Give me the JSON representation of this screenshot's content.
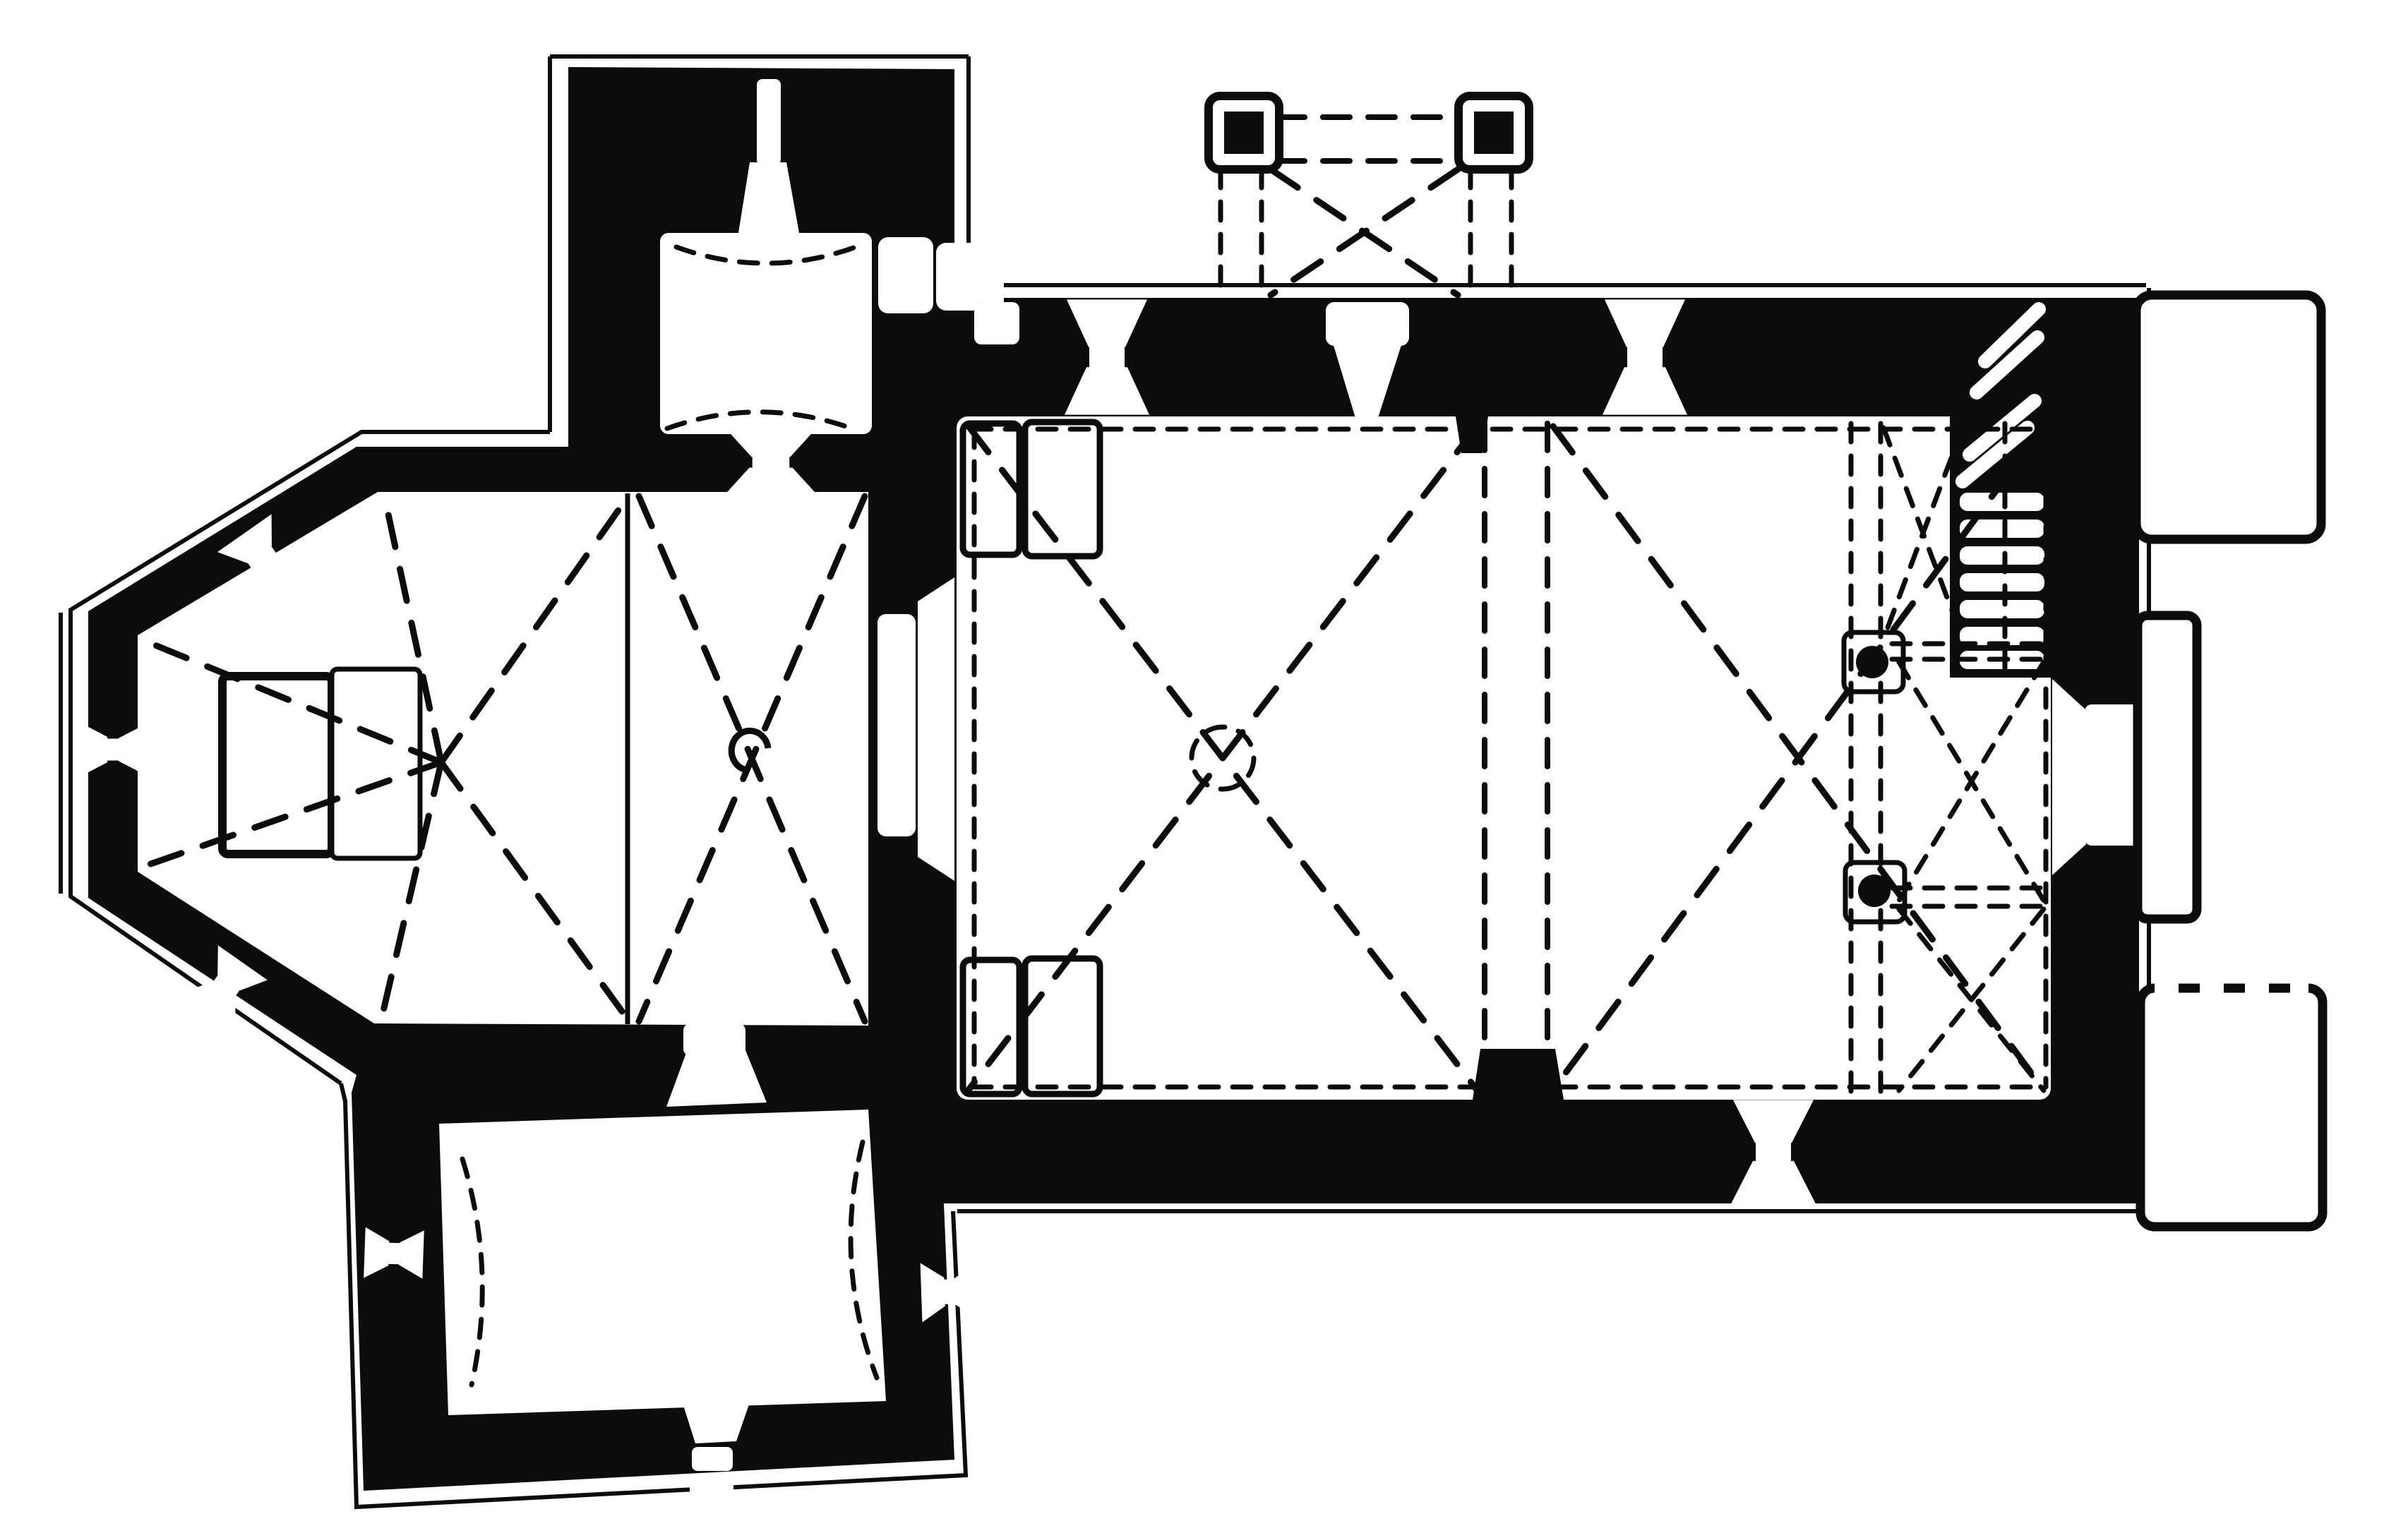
{
  "title": "Church floor plan (measured survey drawing, black ink on white)",
  "colors": {
    "ink": "#0c0c0c",
    "paper": "#ffffff"
  },
  "drawing": {
    "type": "architectural-floor-plan",
    "spaces": [
      {
        "id": "apse",
        "label": "Polygonal apse sanctuary with altar and radiating vault ribs"
      },
      {
        "id": "choir",
        "label": "Choir bay with cross rib vault and boss"
      },
      {
        "id": "north-chapel",
        "label": "North chapel / sacristy with barrel vault, window and east door"
      },
      {
        "id": "south-chapel",
        "label": "South chapel with barrel vault and three windows"
      },
      {
        "id": "nave",
        "label": "Nave of two cross-vaulted bays with dashed rib lines and circular boss"
      },
      {
        "id": "porch",
        "label": "Open porch on two square pillars with dashed roof outline"
      },
      {
        "id": "gallery",
        "label": "East gallery on two round columns with three small cross vaults"
      },
      {
        "id": "spiral-staircase",
        "label": "Spiral staircase in north-east corner"
      },
      {
        "id": "buttresses",
        "label": "Three buttresses on the east facade"
      }
    ],
    "conventions": {
      "walls": "solid black poche",
      "vault_ribs": "dashed lines",
      "plinth": "thin outline offset outside walls",
      "windows": "double-splayed white openings in walls"
    }
  }
}
